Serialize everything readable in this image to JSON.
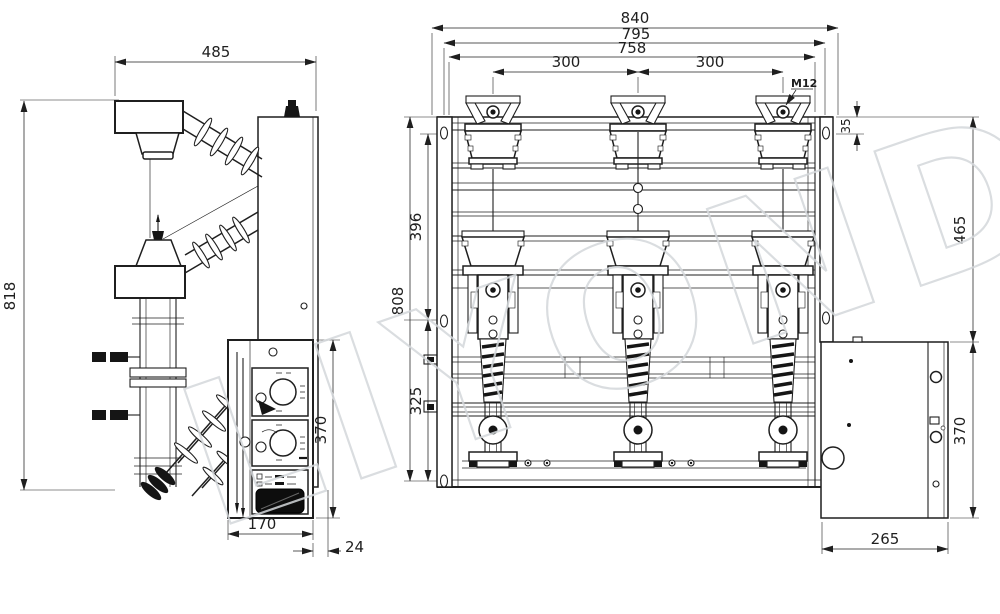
{
  "watermark": {
    "text": "LIYOND"
  },
  "colors": {
    "line": "#1f1f1f",
    "watermark": "#d4d8db",
    "background": "#ffffff",
    "window": "#0d0d0d"
  },
  "side_view": {
    "dim_width": "485",
    "dim_height": "818",
    "dim_panel_height": "370",
    "dim_panel_width": "170",
    "dim_gap": "24"
  },
  "front_view": {
    "dim_overall_width": "840",
    "dim_mounting_width": "795",
    "dim_frame_width": "758",
    "dim_pole_pitch_left": "300",
    "dim_pole_pitch_right": "300",
    "bolt_spec": "M12",
    "dim_hole_offset": "35",
    "dim_upper_height": "465",
    "dim_left_upper": "396",
    "dim_left_total": "808",
    "dim_left_lower": "325",
    "dim_box_height": "370",
    "dim_box_width": "265"
  }
}
